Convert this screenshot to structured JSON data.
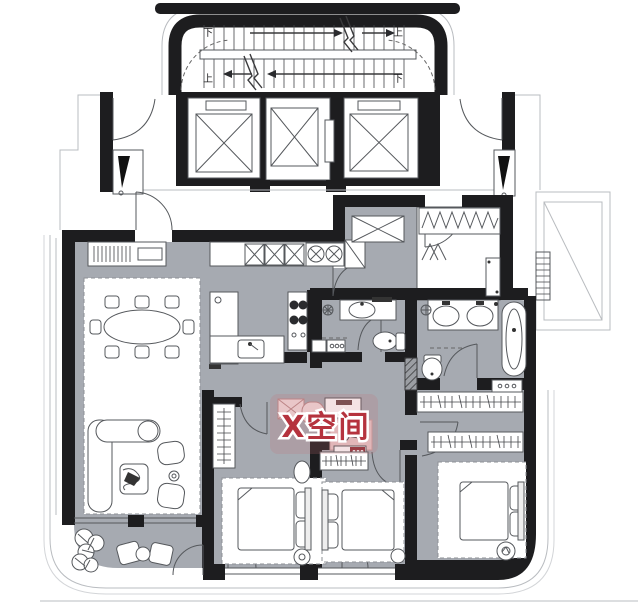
{
  "watermark": {
    "text": "X空间",
    "color": "#b5333e"
  },
  "stairwell": {
    "labels": {
      "upper_left": "下",
      "upper_right": "上",
      "lower_left": "上",
      "lower_right": "下"
    }
  },
  "colors": {
    "wall": "#1d1d1f",
    "floor": "#a6aab1",
    "paper": "#ffffff",
    "line": "#55585c",
    "light_line": "#b9bcc0",
    "rug_dash": "#8d9096",
    "watermark_pink": "#c96e76",
    "accent_red": "#8e3038"
  }
}
